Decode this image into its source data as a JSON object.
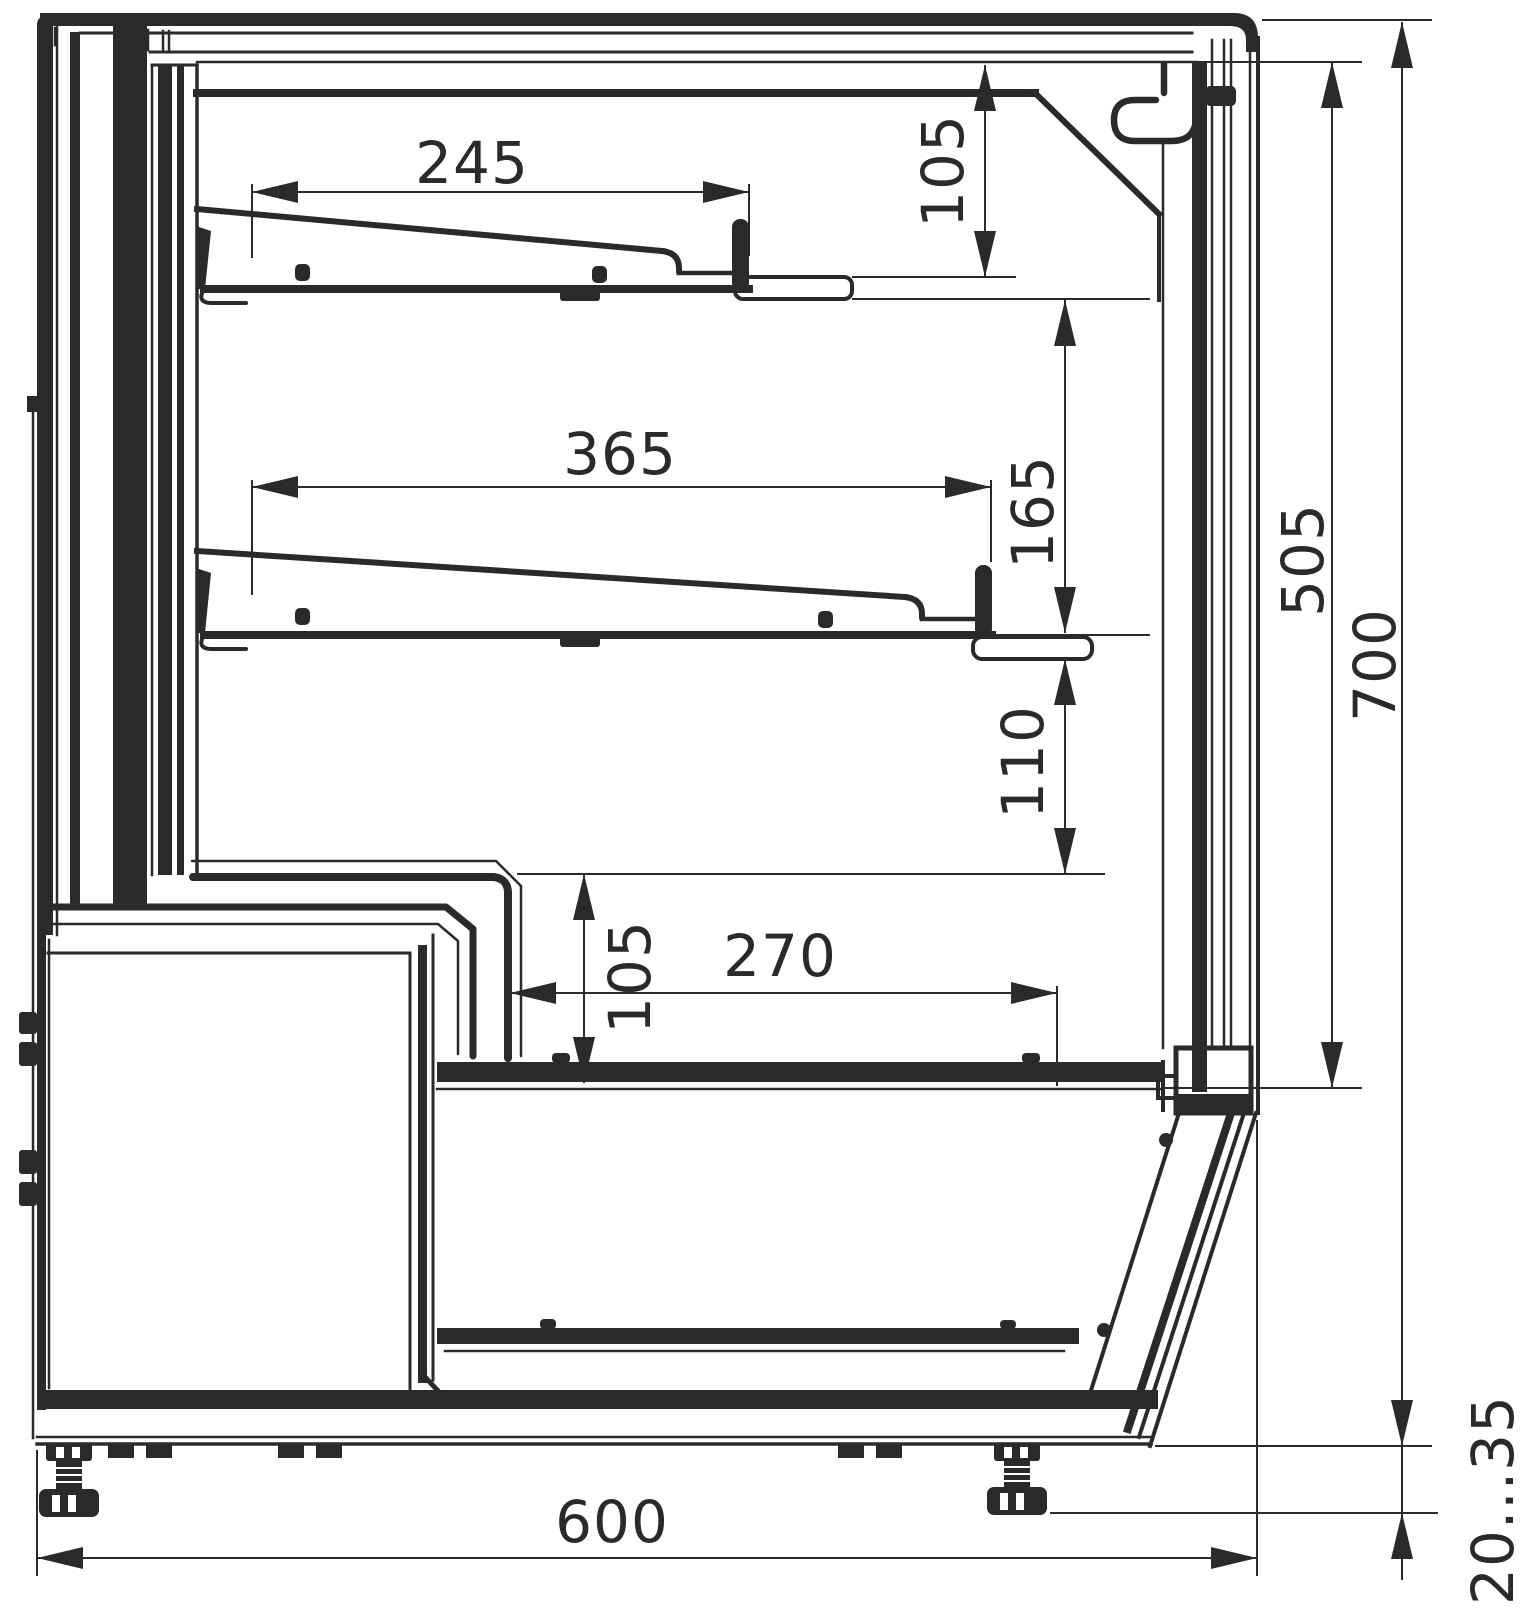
{
  "drawing": {
    "description": "Side cross-section technical drawing of a refrigerated display counter with two sloped shelves, lower well, machine compartment and adjustable feet",
    "line_color": "#2b2a29",
    "background": "#ffffff",
    "dims": {
      "shelf_top_depth": "245",
      "canopy_to_shelf": "105",
      "shelf_mid_depth": "365",
      "shelf_gap": "165",
      "inner_height": "505",
      "overall_height": "700",
      "shelf_to_step": "110",
      "well_height": "105",
      "well_depth": "270",
      "base_depth": "600",
      "foot_adjust_range": "20...35"
    }
  }
}
